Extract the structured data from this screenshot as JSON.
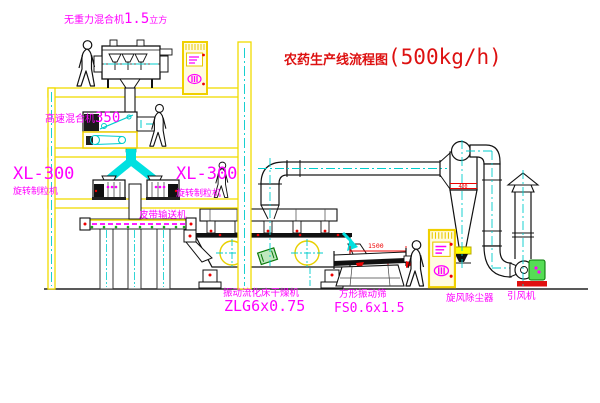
{
  "title": {
    "cn": "农药生产线流程图",
    "capacity": "(500kg/h)"
  },
  "labels": {
    "mixer1": {
      "name": "无重力混合机",
      "size": "1.5",
      "unit": "立方"
    },
    "mixer2": {
      "name": "高速混合机",
      "model": "350"
    },
    "granulator_left": {
      "model": "XL-300",
      "name": "旋转制粒机"
    },
    "granulator_right": {
      "model": "XL-300",
      "name": "旋转制粒机"
    },
    "conveyor": {
      "name": "皮带输送机"
    },
    "dryer": {
      "name": "振动流化床干燥机",
      "model": "ZLG6x0.75"
    },
    "sieve": {
      "name": "方形振动筛",
      "model": "FS0.6x1.5",
      "length_dim": "1500"
    },
    "cyclone": {
      "name": "旋风除尘器",
      "marking": "400"
    },
    "fan": {
      "name": "引风机"
    }
  },
  "colors": {
    "structure_yellow": "#f0dc00",
    "cabinet_yellow": "#f0d000",
    "centerline_cyan": "#00cccc",
    "chute_cyan": "#00e0e0",
    "label_magenta": "#ff00ff",
    "title_red": "#dd1111",
    "alert_red": "#ee0000",
    "motor_green": "#22cc22",
    "line_black": "#111111",
    "background": "#ffffff"
  },
  "icons": {
    "worker_count": 4,
    "worker": "worker-figure",
    "crosshair": "centerline-crosshair-icon",
    "cabinet": "control-cabinet"
  }
}
